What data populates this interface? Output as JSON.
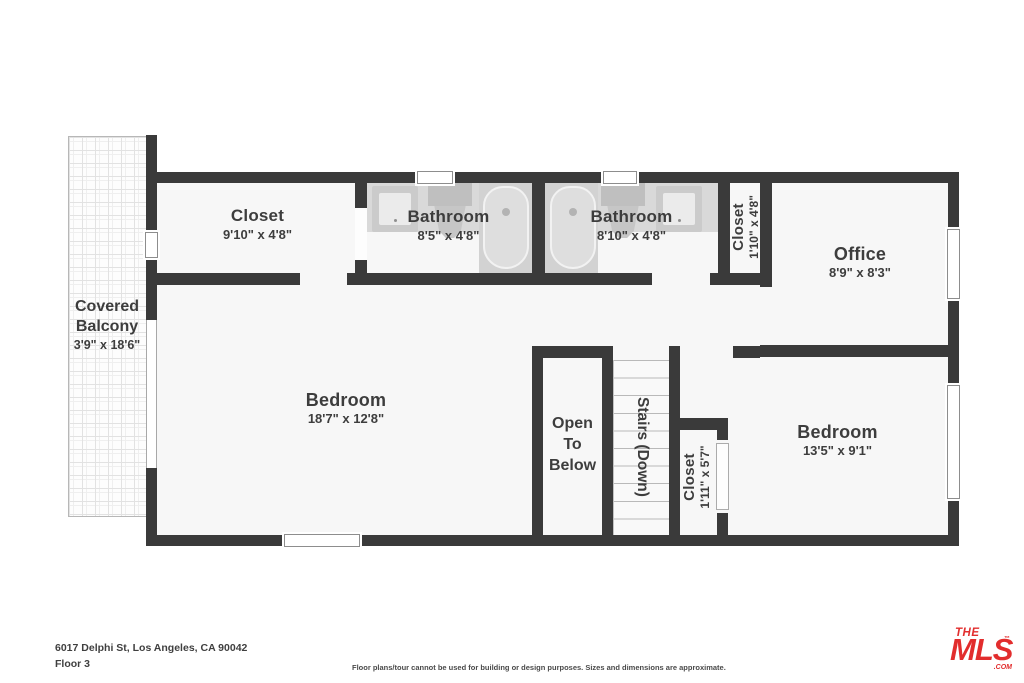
{
  "floorplan": {
    "rooms": {
      "closet1": {
        "name": "Closet",
        "dims": "9'10\" x 4'8\""
      },
      "bathroom1": {
        "name": "Bathroom",
        "dims": "8'5\" x 4'8\""
      },
      "bathroom2": {
        "name": "Bathroom",
        "dims": "8'10\" x 4'8\""
      },
      "closet2": {
        "name": "Closet",
        "dims": "1'10\" x 4'8\""
      },
      "office": {
        "name": "Office",
        "dims": "8'9\" x 8'3\""
      },
      "balcony": {
        "line1": "Covered",
        "line2": "Balcony",
        "dims": "3'9\" x 18'6\""
      },
      "bedroom1": {
        "name": "Bedroom",
        "dims": "18'7\" x 12'8\""
      },
      "open_to_below": {
        "line1": "Open",
        "line2": "To",
        "line3": "Below"
      },
      "stairs": {
        "label": "Stairs (Down)"
      },
      "closet3": {
        "name": "Closet",
        "dims": "1'11\" x 5'7\""
      },
      "bedroom2": {
        "name": "Bedroom",
        "dims": "13'5\" x 9'1\""
      }
    },
    "footer": {
      "address": "6017 Delphi St, Los Angeles, CA 90042",
      "floor": "Floor 3",
      "disclaimer": "Floor plans/tour cannot be used for building or design purposes. Sizes and dimensions are approximate."
    },
    "logo": {
      "the": "THE",
      "mls": "MLS",
      "tm": "™",
      "com": ".COM"
    },
    "colors": {
      "wall": "#3a3a3a",
      "room_fill": "#f7f7f7",
      "fixture_gray": "#d9d9d9",
      "logo_red": "#e22d2d",
      "text": "#3d3d3d"
    }
  }
}
